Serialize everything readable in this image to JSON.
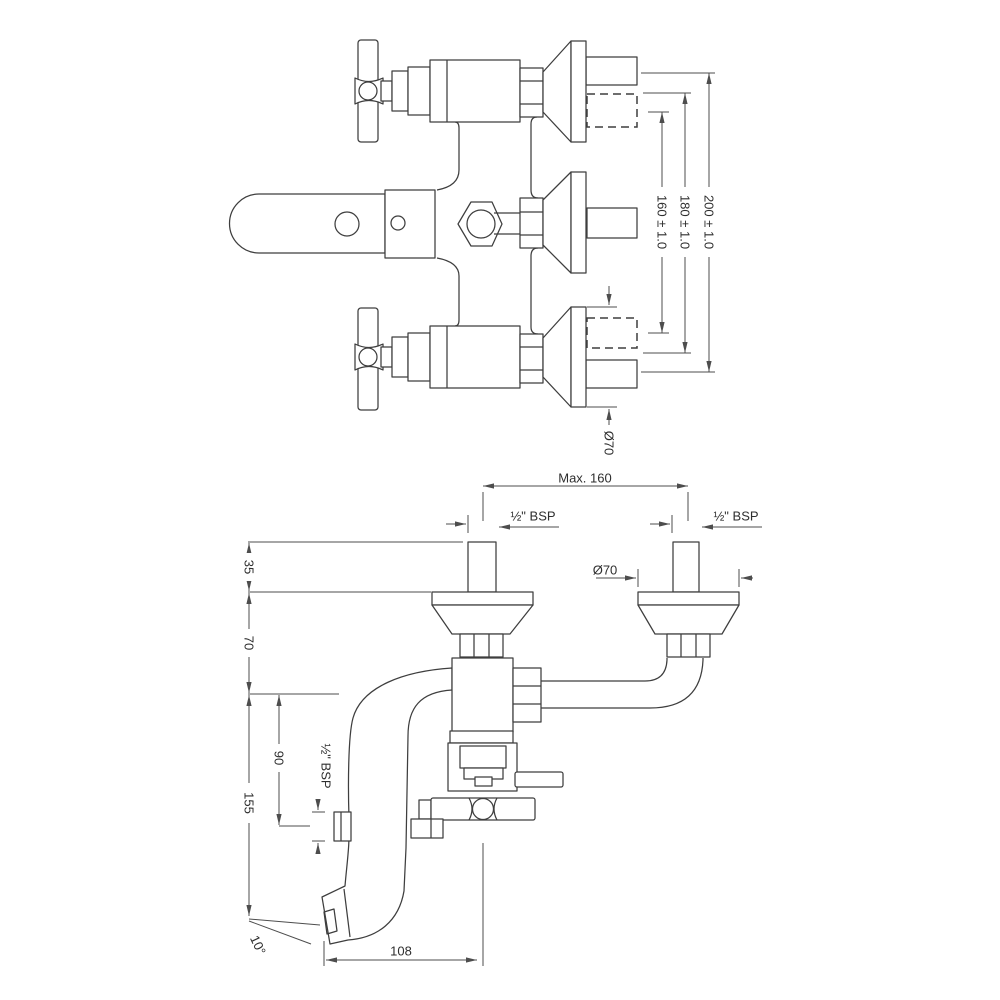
{
  "drawing": {
    "colors": {
      "background": "#ffffff",
      "object_line": "#3e3e3e",
      "dimension_line": "#4d4d4d"
    },
    "top_view": {
      "dim_200": "200 ± 1.0",
      "dim_180": "180 ± 1.0",
      "dim_160": "160 ± 1.0",
      "flange_diameter": "Ø70"
    },
    "front_view": {
      "max_spread": "Max. 160",
      "thread_left": "½\" BSP",
      "thread_right": "½\" BSP",
      "flange_diameter": "Ø70",
      "wall_offset": "35",
      "flange_to_spout": "70",
      "spout_to_outlet": "90",
      "spout_drop": "155",
      "outlet_thread": "½\" BSP",
      "spout_angle": "10°",
      "spout_reach": "108"
    }
  }
}
